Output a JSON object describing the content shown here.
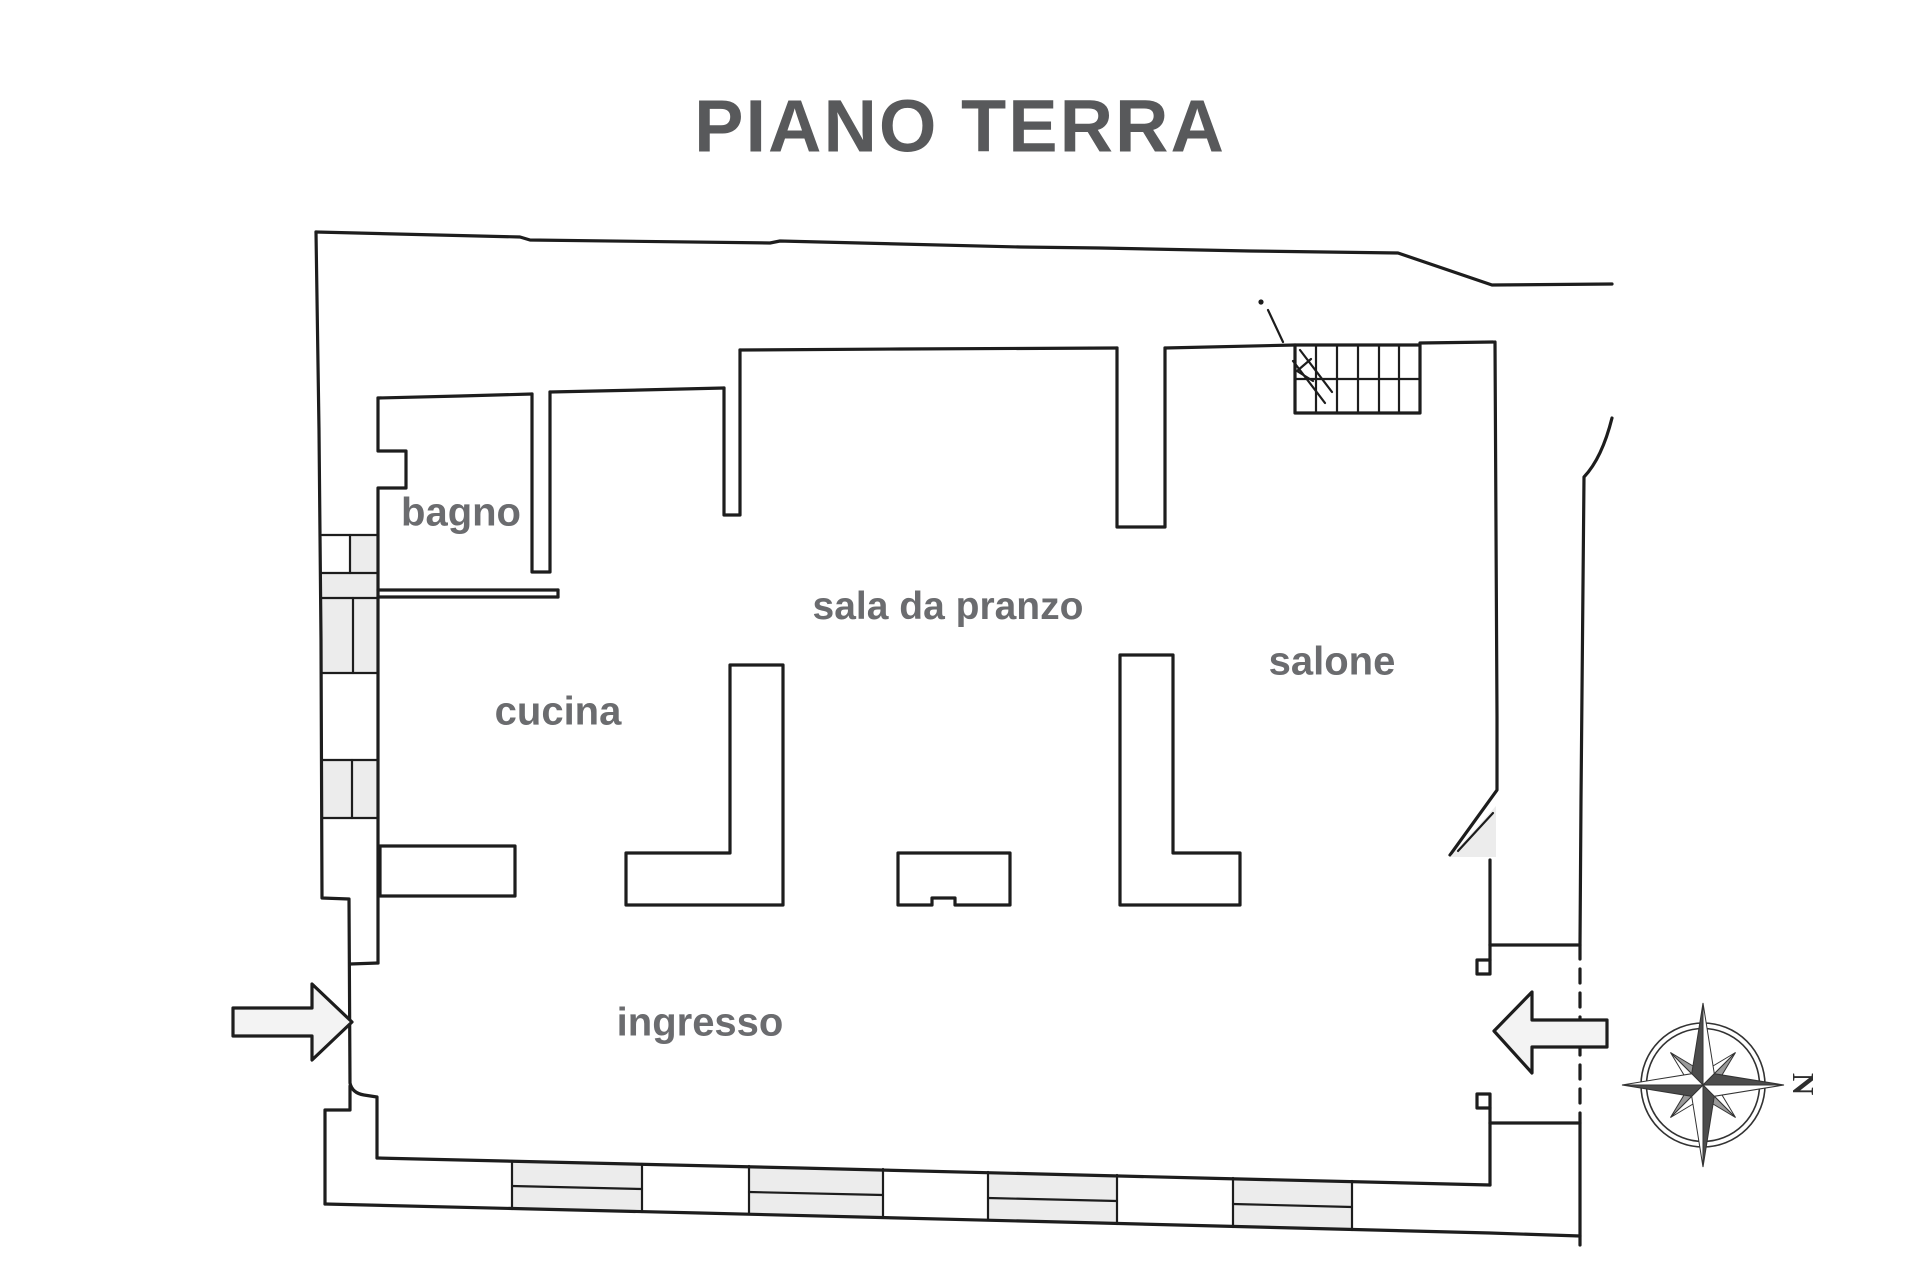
{
  "title": "PIANO TERRA",
  "rooms": {
    "bagno": {
      "label": "bagno"
    },
    "cucina": {
      "label": "cucina"
    },
    "sala_da_pranzo": {
      "label": "sala da pranzo"
    },
    "salone": {
      "label": "salone"
    },
    "ingresso": {
      "label": "ingresso"
    }
  },
  "compass": {
    "north_label": "N"
  },
  "colors": {
    "line": "#1d1d1d",
    "title": "#58595b",
    "label": "#6b6c6f",
    "shade": "#ececec"
  }
}
